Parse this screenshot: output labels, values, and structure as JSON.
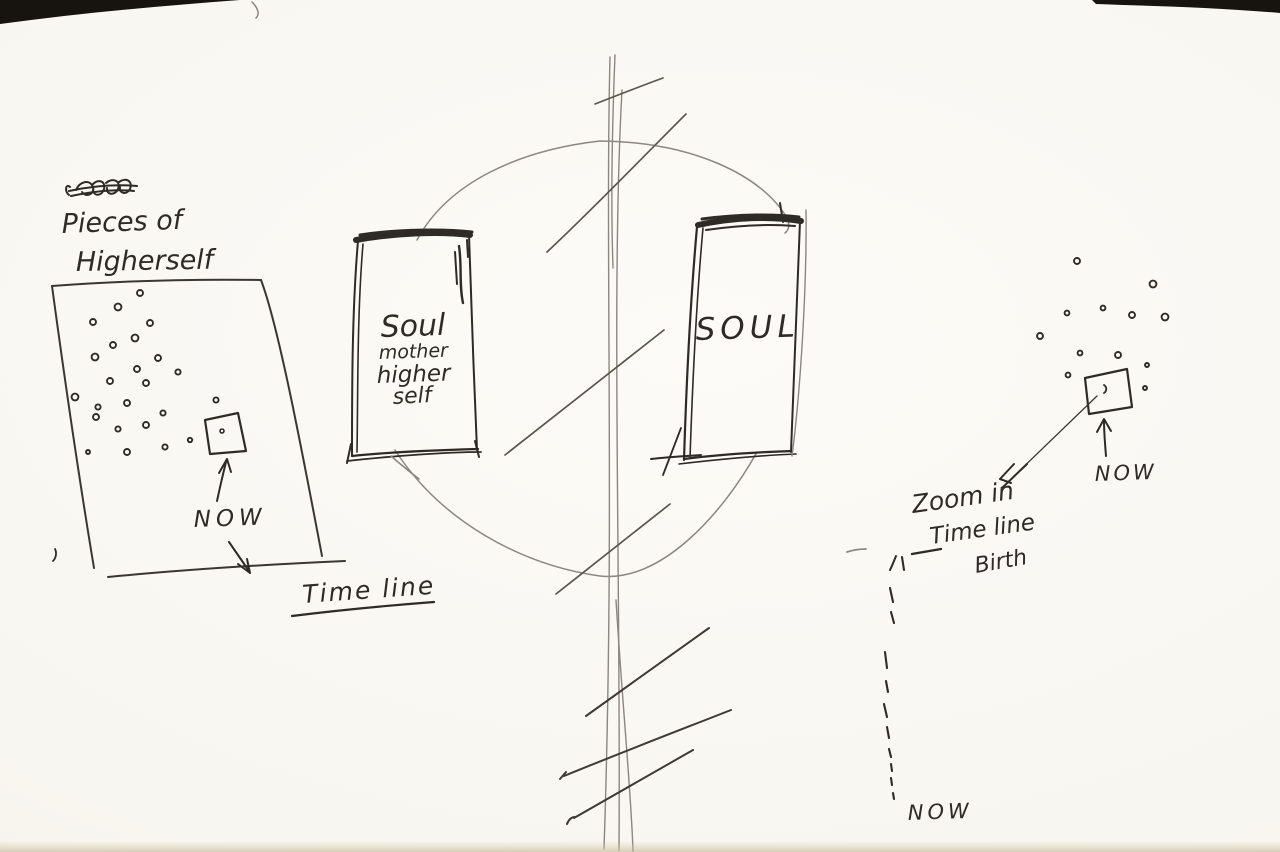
{
  "colors": {
    "paper": "#f9f7f2",
    "ink": "#2e2b27",
    "pen_light": "#3a3733",
    "pencil": "#8b8680",
    "graphite": "#5a564f",
    "hatch": "#3d3a34",
    "table_edge": "#17130f"
  },
  "labels": {
    "pieces_line1": "Pieces of",
    "pieces_line2": "Higherself",
    "left_now": "NOW",
    "timeline": "Time line",
    "soul_card": {
      "line1": "Soul",
      "line2": "mother",
      "line3": "higher",
      "line4": "self"
    },
    "soul_right": "SOUL",
    "zoom_note": {
      "line1": "Zoom in",
      "line2": "Time line",
      "line3": "Birth"
    },
    "right_now": "NOW",
    "bottom_now": "NOW"
  },
  "left_panel": {
    "dots": [
      [
        140,
        293,
        3
      ],
      [
        118,
        307,
        3.4
      ],
      [
        93,
        322,
        3
      ],
      [
        150,
        323,
        3
      ],
      [
        135,
        338,
        3.4
      ],
      [
        113,
        345,
        3
      ],
      [
        95,
        357,
        3.4
      ],
      [
        158,
        358,
        3
      ],
      [
        137,
        369,
        3
      ],
      [
        178,
        372,
        2.6
      ],
      [
        110,
        381,
        3
      ],
      [
        146,
        383,
        3
      ],
      [
        75,
        397,
        3.4
      ],
      [
        216,
        400,
        2.6
      ],
      [
        127,
        403,
        3
      ],
      [
        98,
        407,
        2.6
      ],
      [
        163,
        413,
        2.6
      ],
      [
        96,
        417,
        3
      ],
      [
        146,
        425,
        3
      ],
      [
        118,
        429,
        2.6
      ],
      [
        190,
        440,
        2.2
      ],
      [
        165,
        447,
        2.6
      ],
      [
        127,
        452,
        3
      ],
      [
        88,
        452,
        2
      ]
    ],
    "square_dot": [
      222,
      431,
      2
    ]
  },
  "right_cluster": {
    "dots": [
      [
        1077,
        261,
        3
      ],
      [
        1153,
        284,
        3.4
      ],
      [
        1103,
        308,
        2.4
      ],
      [
        1067,
        313,
        2.4
      ],
      [
        1132,
        315,
        3
      ],
      [
        1165,
        317,
        3.4
      ],
      [
        1040,
        336,
        3
      ],
      [
        1080,
        353,
        2.4
      ],
      [
        1118,
        355,
        3
      ],
      [
        1147,
        365,
        2
      ],
      [
        1068,
        375,
        2.4
      ],
      [
        1145,
        388,
        2
      ]
    ]
  },
  "dashed_timeline": {
    "segments": [
      [
        902,
        557,
        904,
        570
      ],
      [
        890,
        588,
        893,
        602
      ],
      [
        891,
        612,
        894,
        623
      ],
      [
        885,
        652,
        887,
        668
      ],
      [
        886,
        681,
        888,
        692
      ],
      [
        884,
        704,
        887,
        717
      ],
      [
        887,
        727,
        889,
        738
      ],
      [
        889,
        749,
        891,
        757
      ],
      [
        891,
        764,
        892,
        771
      ],
      [
        891,
        778,
        892,
        785
      ],
      [
        893,
        793,
        894,
        799
      ]
    ]
  }
}
